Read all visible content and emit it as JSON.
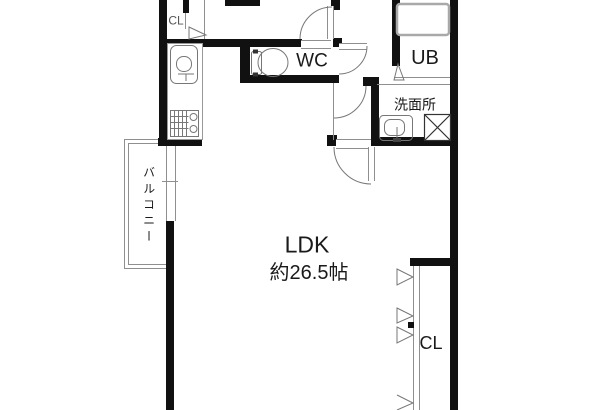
{
  "rooms": {
    "ldk": {
      "name": "LDK",
      "area": "約26.5帖"
    },
    "wc": {
      "name": "WC"
    },
    "bath": {
      "name": "UB"
    },
    "washroom": {
      "name": "洗面所"
    },
    "balcony": {
      "name": "バルコニー"
    },
    "closet_upper": {
      "name": "CL"
    },
    "closet_lower": {
      "name": "CL"
    }
  },
  "colors": {
    "wall": "#111111",
    "thin_line": "#8f8f8f",
    "fixture_line": "#777777",
    "background": "#ffffff",
    "text": "#1a1a1a"
  }
}
